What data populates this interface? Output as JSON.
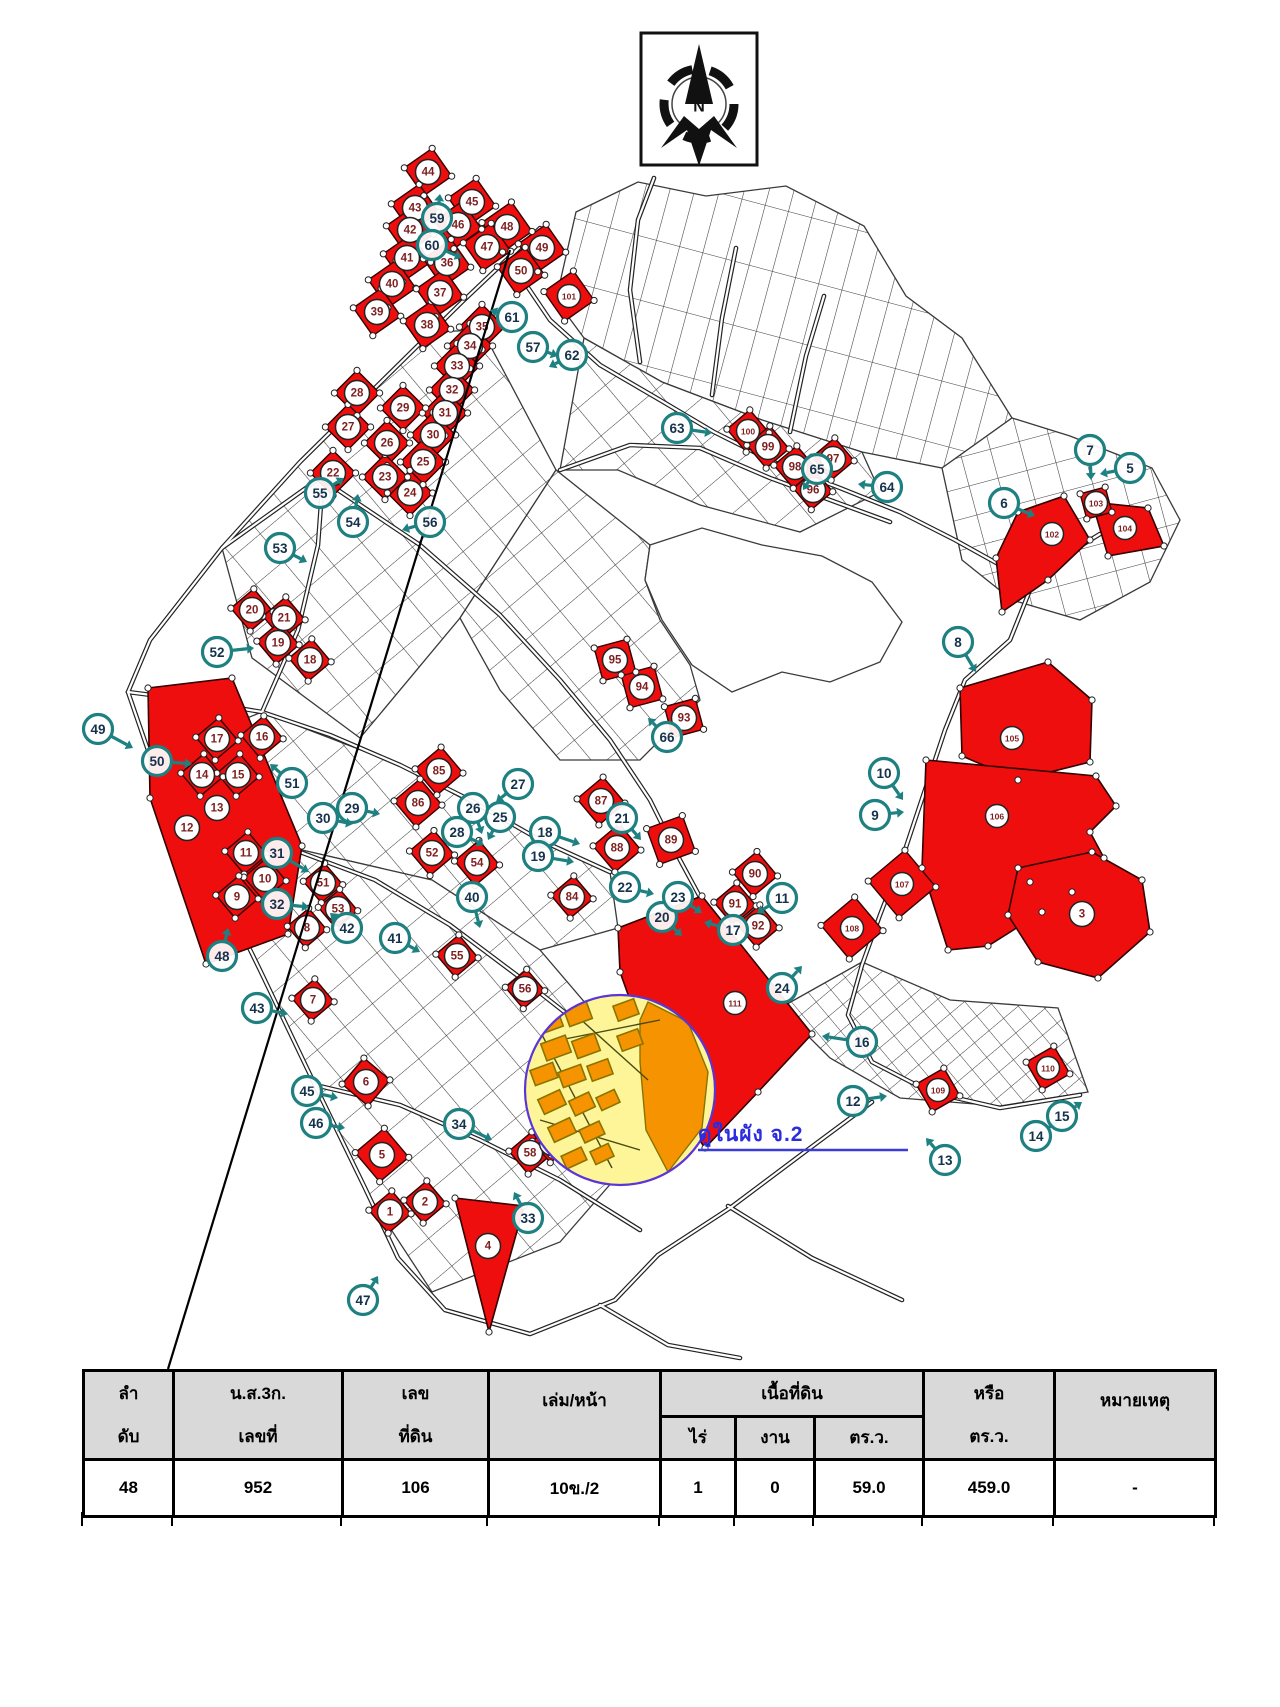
{
  "compass": {
    "label": "N"
  },
  "note": {
    "text": "ดูในผัง จ.2",
    "color": "#2b2bdf"
  },
  "colors": {
    "parcel_red": "#ee0e0e",
    "parcel_number": "#7d1f1f",
    "teal": "#1e8080",
    "zone_yellow": "#fdf598",
    "zone_orange": "#f59300",
    "zone_ring": "#5a35d8",
    "road": "#222222",
    "header_gray": "#d9d9d9"
  },
  "map": {
    "black_line": {
      "x1": 510,
      "y1": 250,
      "x2": 168,
      "y2": 1369
    },
    "blocks": [
      {
        "pattern": "strips",
        "points": "556,300 576,212 638,182 706,196 786,186 864,226 906,296 962,338 1012,418 942,468 862,452 762,420 662,382 584,338"
      },
      {
        "pattern": "p2",
        "points": "1012,418 1070,436 1152,468 1180,520 1150,582 1080,620 1012,600 962,560 942,468"
      },
      {
        "pattern": "p1",
        "points": "584,338 662,382 762,420 862,452 880,492 800,532 700,505 618,470 560,470"
      },
      {
        "pattern": "p1",
        "points": "300,462 430,332 482,330 556,470 460,618 360,738 252,658 222,548"
      },
      {
        "pattern": "p1",
        "points": "460,618 556,470 650,545 645,580 660,620 690,665 700,700 640,760 560,760 500,690"
      },
      {
        "pattern": "p1",
        "points": "152,756 262,712 400,765 540,840 610,872 618,928 540,950 432,880 302,850 208,862"
      },
      {
        "pattern": "p1",
        "points": "208,862 302,850 432,880 540,950 610,1032 640,1150 560,1242 432,1292 362,1185 312,1082 258,968"
      },
      {
        "pattern": "p3",
        "points": "780,1008 862,962 950,1000 1058,1008 1088,1092 1000,1106 900,1098 830,1058"
      }
    ],
    "lake": "650,545 702,528 762,545 822,556 872,582 902,622 880,662 830,682 782,672 732,692 692,665 662,620 645,580",
    "roads": [
      "508,258 550,320 600,365 660,400 714,432 780,465 840,488 900,512 955,540 1000,565 1030,590",
      "540,228 462,302 385,378 300,462 222,548 150,640 128,692",
      "128,692 150,756 208,864 260,970 315,1085 365,1188 398,1258 445,1310 530,1334 615,1300 658,1255",
      "222,548 320,478 420,545 500,615 560,680 610,740 650,800 680,860 700,897",
      "128,692 190,700 262,712 330,735 400,765 470,800 540,840 610,872",
      "208,864 300,852 375,880 450,925 530,985 600,1040 640,1090",
      "1030,590 1010,640 965,680 945,730 925,790 905,850 880,915 862,965 848,1015 872,1062 930,1092 1000,1108 1080,1095",
      "560,470 630,445 700,448 770,478 830,500 890,522",
      "640,362 630,290 638,220 654,178",
      "712,395 722,318 736,248",
      "790,432 806,356 824,296",
      "262,712 298,630 318,545 322,490",
      "1030,590 1064,556 1100,534 1148,520",
      "658,1255 730,1208 802,1154 872,1102",
      "600,1305 668,1345 740,1358",
      "728,1206 812,1258 902,1300",
      "315,1085 400,1105 480,1140 560,1180 640,1230"
    ],
    "red_squares": [
      [
        "44",
        428,
        172,
        17,
        -35
      ],
      [
        "43",
        415,
        208,
        17,
        -35
      ],
      [
        "45",
        472,
        202,
        17,
        -35
      ],
      [
        "42",
        410,
        230,
        17,
        -35
      ],
      [
        "46",
        458,
        225,
        17,
        -35
      ],
      [
        "48",
        507,
        227,
        18,
        -35
      ],
      [
        "47",
        487,
        247,
        17,
        -35
      ],
      [
        "49",
        542,
        248,
        17,
        -35
      ],
      [
        "41",
        407,
        258,
        17,
        -35
      ],
      [
        "36",
        447,
        263,
        17,
        -35
      ],
      [
        "50",
        521,
        271,
        17,
        -35
      ],
      [
        "40",
        392,
        284,
        17,
        -35
      ],
      [
        "37",
        440,
        293,
        17,
        -35
      ],
      [
        "39",
        377,
        312,
        17,
        -35
      ],
      [
        "38",
        427,
        325,
        17,
        -35
      ],
      [
        "101",
        569,
        296,
        18,
        -35
      ],
      [
        "35",
        482,
        327,
        16,
        -45
      ],
      [
        "34",
        470,
        346,
        16,
        -45
      ],
      [
        "33",
        457,
        366,
        16,
        -45
      ],
      [
        "32",
        452,
        390,
        16,
        -45
      ],
      [
        "31",
        445,
        413,
        16,
        -45
      ],
      [
        "30",
        433,
        435,
        16,
        -45
      ],
      [
        "29",
        403,
        408,
        16,
        -45
      ],
      [
        "28",
        357,
        393,
        16,
        -45
      ],
      [
        "27",
        348,
        427,
        16,
        -45
      ],
      [
        "26",
        387,
        443,
        16,
        -45
      ],
      [
        "25",
        423,
        462,
        16,
        -45
      ],
      [
        "24",
        410,
        493,
        16,
        -45
      ],
      [
        "23",
        385,
        477,
        16,
        -45
      ],
      [
        "22",
        333,
        473,
        16,
        -45
      ],
      [
        "20",
        252,
        610,
        15,
        -40
      ],
      [
        "21",
        284,
        618,
        15,
        -40
      ],
      [
        "19",
        278,
        643,
        15,
        -40
      ],
      [
        "18",
        310,
        660,
        15,
        -40
      ],
      [
        "16",
        262,
        737,
        15,
        -40
      ],
      [
        "17",
        217,
        739,
        15,
        -40
      ],
      [
        "14",
        202,
        775,
        15,
        -40
      ],
      [
        "15",
        238,
        775,
        15,
        -40
      ],
      [
        "13",
        217,
        808,
        0,
        0
      ],
      [
        "12",
        187,
        828,
        0,
        0
      ],
      [
        "11",
        246,
        853,
        15,
        -40
      ],
      [
        "10",
        265,
        879,
        15,
        -40
      ],
      [
        "9",
        237,
        897,
        15,
        -40
      ],
      [
        "51",
        323,
        883,
        14,
        -40
      ],
      [
        "53",
        338,
        909,
        14,
        -40
      ],
      [
        "8",
        307,
        928,
        14,
        -40
      ],
      [
        "85",
        439,
        771,
        17,
        -40
      ],
      [
        "86",
        418,
        803,
        17,
        -40
      ],
      [
        "52",
        432,
        853,
        16,
        -40
      ],
      [
        "54",
        477,
        863,
        16,
        -40
      ],
      [
        "87",
        601,
        801,
        17,
        -40
      ],
      [
        "88",
        617,
        848,
        17,
        -40
      ],
      [
        "89",
        671,
        840,
        19,
        -20
      ],
      [
        "84",
        572,
        897,
        15,
        -40
      ],
      [
        "90",
        755,
        874,
        16,
        -40
      ],
      [
        "91",
        735,
        904,
        15,
        -40
      ],
      [
        "92",
        758,
        926,
        15,
        -40
      ],
      [
        "93",
        684,
        718,
        16,
        -15
      ],
      [
        "94",
        642,
        687,
        17,
        -15
      ],
      [
        "95",
        615,
        660,
        17,
        -15
      ],
      [
        "100",
        748,
        431,
        15,
        -40
      ],
      [
        "99",
        768,
        447,
        15,
        -40
      ],
      [
        "98",
        795,
        467,
        15,
        -40
      ],
      [
        "97",
        833,
        459,
        15,
        -40
      ],
      [
        "96",
        813,
        490,
        14,
        -40
      ],
      [
        "107",
        902,
        884,
        24,
        -40
      ],
      [
        "108",
        852,
        928,
        22,
        -40
      ],
      [
        "103",
        1096,
        503,
        13,
        -15
      ],
      [
        "109",
        938,
        1090,
        16,
        -30
      ],
      [
        "110",
        1048,
        1068,
        16,
        -30
      ],
      [
        "55",
        457,
        956,
        15,
        -40
      ],
      [
        "56",
        525,
        989,
        14,
        -40
      ],
      [
        "7",
        313,
        1000,
        15,
        -40
      ],
      [
        "6",
        366,
        1082,
        17,
        -50
      ],
      [
        "5",
        382,
        1155,
        19,
        -40
      ],
      [
        "1",
        390,
        1212,
        15,
        -40
      ],
      [
        "2",
        425,
        1202,
        15,
        -40
      ],
      [
        "58",
        530,
        1153,
        15,
        -40
      ],
      [
        "57",
        552,
        1143,
        14,
        -40
      ]
    ],
    "red_polygons": [
      {
        "n": "105",
        "lx": 1012,
        "ly": 738,
        "points": "960,688 1048,662 1092,700 1090,762 1018,780 962,756"
      },
      {
        "n": "106",
        "lx": 997,
        "ly": 816,
        "points": "926,760 1096,776 1116,806 1090,832 1104,858 1072,892 1030,882 1042,912 988,946 948,950 922,868"
      },
      {
        "n": "3",
        "lx": 1082,
        "ly": 914,
        "points": "1018,868 1092,852 1142,880 1150,932 1098,978 1038,962 1008,915"
      },
      {
        "n": "111",
        "lx": 735,
        "ly": 1003,
        "points": "618,928 702,896 812,1034 758,1092 705,1148 666,1092 640,1028 620,972"
      },
      {
        "n": "102",
        "lx": 1052,
        "ly": 534,
        "points": "1018,512 1064,496 1090,540 1048,580 1002,612 996,558"
      },
      {
        "n": "104",
        "lx": 1125,
        "ly": 528,
        "points": "1092,502 1148,508 1164,546 1108,556"
      },
      {
        "n": "",
        "lx": 0,
        "ly": 0,
        "points": "148,688 232,678 302,846 288,934 206,964 150,798"
      },
      {
        "n": "4",
        "lx": 488,
        "ly": 1246,
        "points": "455,1198 524,1206 489,1332"
      }
    ],
    "detail_zone": {
      "cx": 620,
      "cy": 1090,
      "r": 95,
      "crescent": "648,1002 688,1022 708,1072 702,1128 668,1172 646,1130 640,1062 640,1020",
      "streets": [
        "530,1012 612,1168",
        "548,990 648,1080",
        "540,1120 640,1150",
        "560,1040 660,1020"
      ],
      "orange_parcels": [
        [
          548,
          1022,
          26,
          18,
          -20
        ],
        [
          578,
          1014,
          24,
          18,
          -20
        ],
        [
          556,
          1048,
          26,
          18,
          -20
        ],
        [
          586,
          1046,
          24,
          18,
          -20
        ],
        [
          544,
          1074,
          24,
          16,
          -20
        ],
        [
          572,
          1076,
          24,
          16,
          -20
        ],
        [
          600,
          1070,
          22,
          16,
          -20
        ],
        [
          552,
          1102,
          24,
          16,
          -25
        ],
        [
          582,
          1104,
          22,
          16,
          -25
        ],
        [
          608,
          1100,
          20,
          14,
          -25
        ],
        [
          562,
          1130,
          24,
          16,
          -25
        ],
        [
          592,
          1132,
          22,
          14,
          -25
        ],
        [
          574,
          1158,
          22,
          14,
          -25
        ],
        [
          602,
          1154,
          20,
          14,
          -25
        ],
        [
          630,
          1040,
          22,
          16,
          -20
        ],
        [
          626,
          1010,
          22,
          16,
          -20
        ]
      ]
    },
    "note_underline": {
      "x1": 698,
      "y1": 1150,
      "x2": 908,
      "y2": 1150
    },
    "teal_markers": [
      [
        "5",
        1130,
        468,
        1100,
        474
      ],
      [
        "6",
        1004,
        503,
        1035,
        516
      ],
      [
        "7",
        1090,
        450,
        1091,
        480
      ],
      [
        "8",
        958,
        642,
        976,
        672
      ],
      [
        "9",
        875,
        815,
        904,
        812
      ],
      [
        "10",
        884,
        773,
        903,
        800
      ],
      [
        "11",
        782,
        898,
        757,
        913
      ],
      [
        "12",
        853,
        1101,
        887,
        1096
      ],
      [
        "13",
        945,
        1160,
        926,
        1138
      ],
      [
        "14",
        1036,
        1136,
        1057,
        1122
      ],
      [
        "15",
        1062,
        1116,
        1082,
        1102
      ],
      [
        "16",
        862,
        1042,
        822,
        1036
      ],
      [
        "17",
        733,
        930,
        704,
        922
      ],
      [
        "18",
        545,
        832,
        580,
        844
      ],
      [
        "19",
        538,
        856,
        574,
        862
      ],
      [
        "20",
        662,
        917,
        682,
        936
      ],
      [
        "21",
        622,
        818,
        641,
        840
      ],
      [
        "22",
        625,
        887,
        654,
        894
      ],
      [
        "23",
        678,
        897,
        702,
        913
      ],
      [
        "24",
        782,
        988,
        802,
        966
      ],
      [
        "25",
        500,
        817,
        488,
        840
      ],
      [
        "26",
        473,
        808,
        482,
        834
      ],
      [
        "27",
        518,
        784,
        496,
        802
      ],
      [
        "28",
        457,
        832,
        484,
        845
      ],
      [
        "29",
        352,
        808,
        380,
        814
      ],
      [
        "30",
        323,
        818,
        353,
        824
      ],
      [
        "31",
        277,
        853,
        309,
        872
      ],
      [
        "32",
        277,
        904,
        309,
        907
      ],
      [
        "33",
        528,
        1218,
        514,
        1192
      ],
      [
        "34",
        459,
        1124,
        492,
        1140
      ],
      [
        "40",
        472,
        897,
        480,
        928
      ],
      [
        "41",
        395,
        938,
        420,
        952
      ],
      [
        "42",
        347,
        928,
        330,
        913
      ],
      [
        "43",
        257,
        1008,
        288,
        1014
      ],
      [
        "45",
        307,
        1091,
        338,
        1098
      ],
      [
        "46",
        316,
        1123,
        345,
        1128
      ],
      [
        "47",
        363,
        1300,
        378,
        1276
      ],
      [
        "48",
        222,
        956,
        228,
        928
      ],
      [
        "49",
        98,
        729,
        133,
        748
      ],
      [
        "50",
        157,
        761,
        192,
        764
      ],
      [
        "51",
        292,
        783,
        270,
        764
      ],
      [
        "52",
        217,
        652,
        254,
        648
      ],
      [
        "53",
        280,
        548,
        307,
        562
      ],
      [
        "54",
        353,
        522,
        358,
        494
      ],
      [
        "55",
        320,
        493,
        344,
        478
      ],
      [
        "56",
        430,
        522,
        402,
        530
      ],
      [
        "57",
        533,
        347,
        558,
        356
      ],
      [
        "59",
        437,
        218,
        440,
        194
      ],
      [
        "60",
        432,
        245,
        462,
        258
      ],
      [
        "61",
        512,
        317,
        490,
        310
      ],
      [
        "62",
        572,
        355,
        549,
        367
      ],
      [
        "63",
        677,
        428,
        712,
        433
      ],
      [
        "64",
        887,
        487,
        858,
        484
      ],
      [
        "65",
        817,
        469,
        803,
        490
      ],
      [
        "66",
        667,
        737,
        648,
        718
      ]
    ]
  },
  "table": {
    "columns_merged": [
      {
        "l1": "ลำ",
        "l2": "ดับ"
      },
      {
        "l1": "น.ส.3ก.",
        "l2": "เลขที่"
      },
      {
        "l1": "เลข",
        "l2": "ที่ดิน"
      },
      {
        "l1": "เล่ม/หน้า",
        "l2": ""
      }
    ],
    "area_group": {
      "label": "เนื้อที่ดิน",
      "subs": [
        "ไร่",
        "งาน",
        "ตร.ว."
      ]
    },
    "columns_after": [
      {
        "l1": "หรือ",
        "l2": "ตร.ว."
      },
      {
        "l1": "หมายเหตุ",
        "l2": ""
      }
    ],
    "widths": [
      90,
      169,
      146,
      172,
      75,
      79,
      109,
      131,
      161
    ],
    "row": [
      "48",
      "952",
      "106",
      "10ข./2",
      "1",
      "0",
      "59.0",
      "459.0",
      "-"
    ]
  }
}
